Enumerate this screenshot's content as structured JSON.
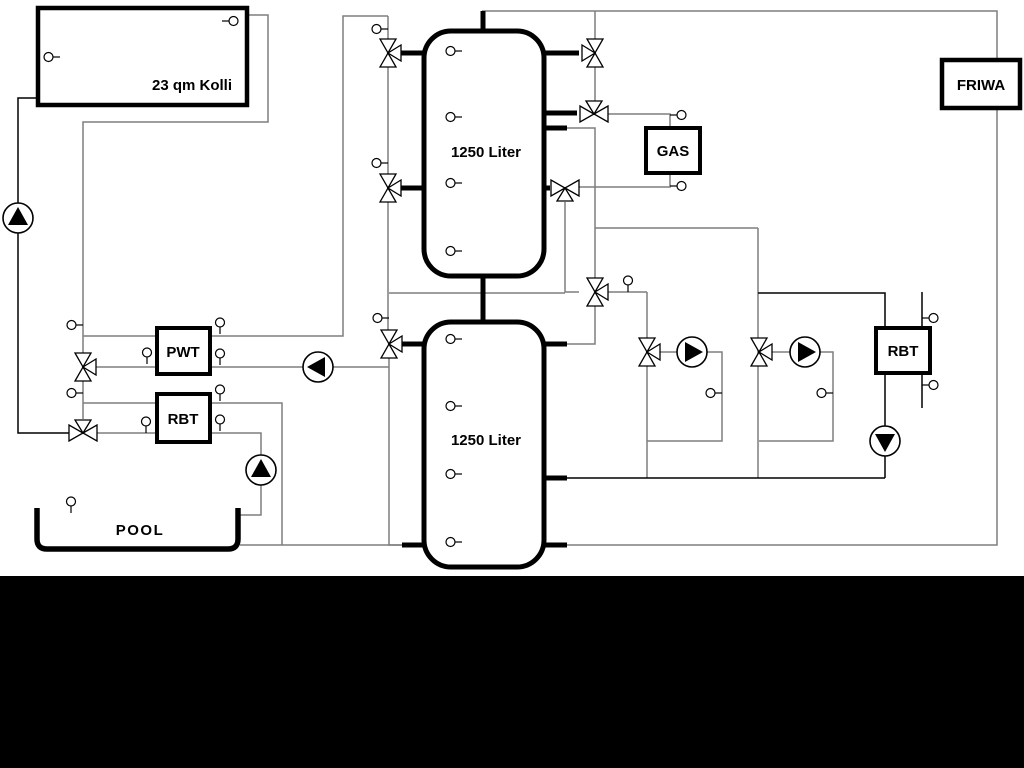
{
  "diagram": {
    "title_labels": {
      "solar_collector": "23 qm Kolli",
      "tank_upper": "1250 Liter",
      "tank_lower": "1250 Liter",
      "pwt": "PWT",
      "rbt_left": "RBT",
      "rbt_right": "RBT",
      "gas_boiler": "GAS",
      "friwa": "FRIWA",
      "pool": "POOL"
    },
    "colors": {
      "pipe_gray": "#7e7e7e",
      "pipe_black": "#000000",
      "component_fill": "#ffffff",
      "footer_bar": "#000000",
      "background": "#ffffff"
    },
    "component_counts": {
      "three_way_valves": 11,
      "pumps": 6,
      "temperature_sensors": 22
    }
  }
}
